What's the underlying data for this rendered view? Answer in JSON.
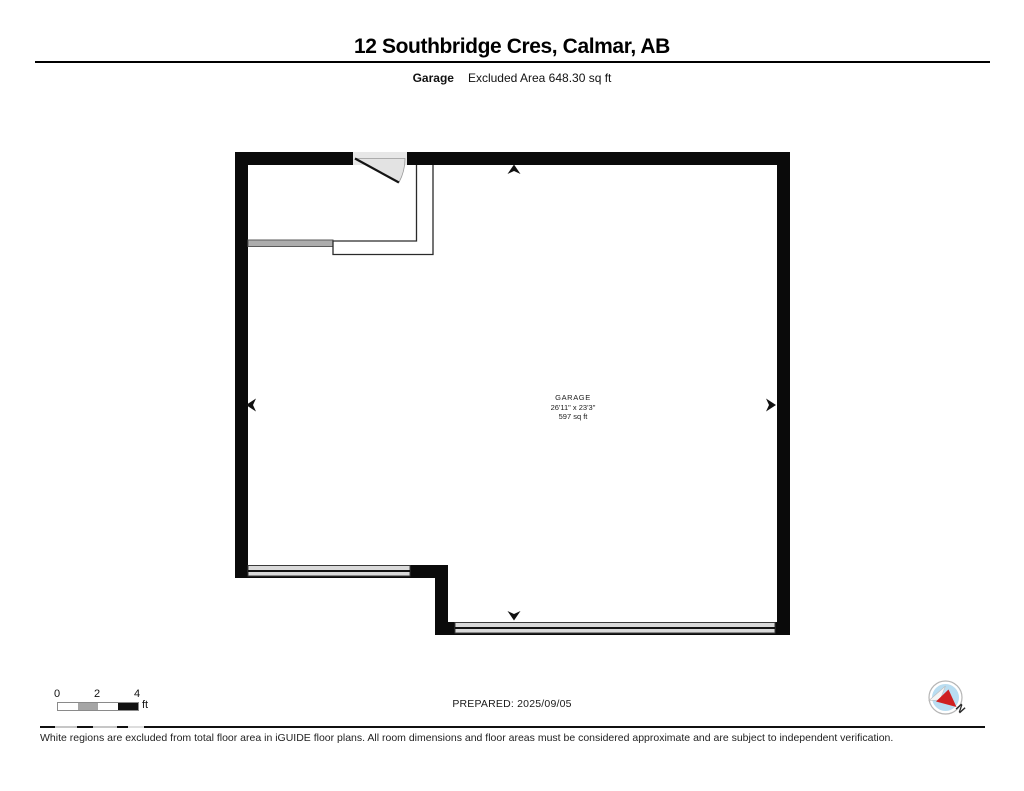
{
  "header": {
    "title": "12 Southbridge Cres, Calmar, AB",
    "section_label": "Garage",
    "excluded_area_label": "Excluded Area 648.30 sq ft"
  },
  "room_label": {
    "name": "GARAGE",
    "dimensions": "26'11\" x 23'3\"",
    "area": "597 sq ft"
  },
  "scale_bar": {
    "ticks": [
      "0",
      "2",
      "4"
    ],
    "unit": "ft"
  },
  "footer": {
    "prepared_label": "PREPARED: 2025/09/05",
    "compass_north_label": "N",
    "disclaimer": "White regions are excluded from total floor area in iGUIDE floor plans. All room dimensions and floor areas must be considered approximate and are subject to independent verification."
  },
  "colors": {
    "wall": "#0a0a0a",
    "window_fill": "#d9d9d9",
    "door_swing_fill": "#e3e3e3",
    "half_wall_fill": "#adadad",
    "compass_face": "#b9ddf1",
    "compass_needle_red": "#cf1f1f"
  }
}
